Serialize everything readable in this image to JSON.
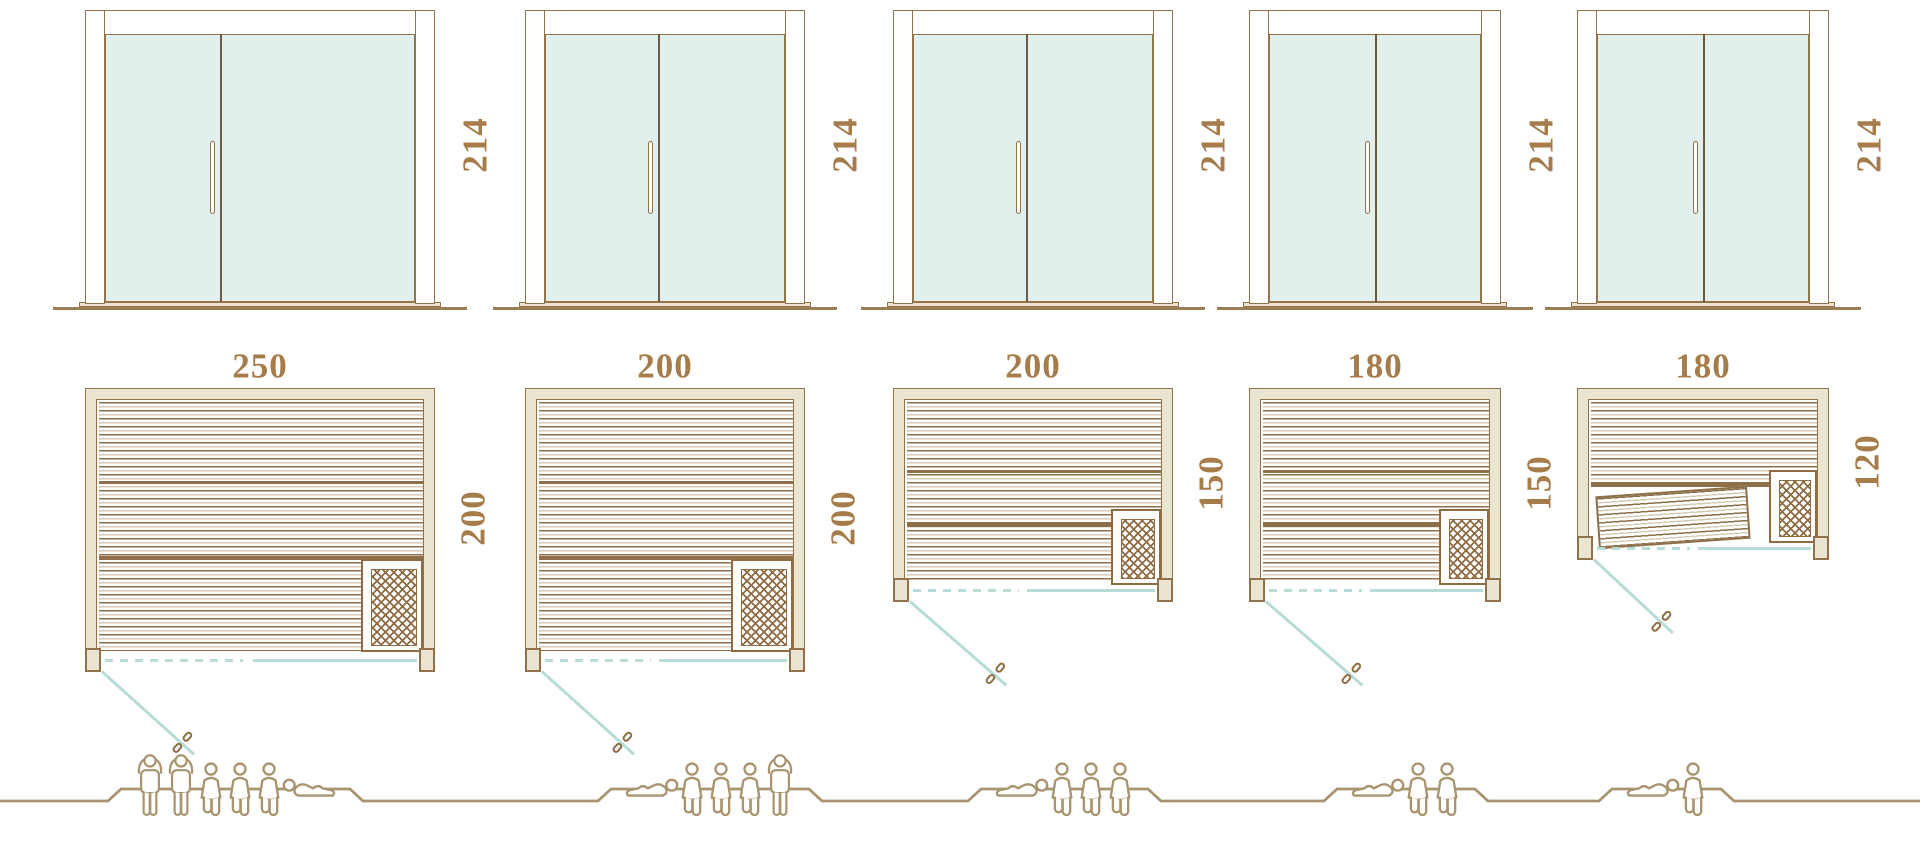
{
  "diagram_title": "sauna-cabin-size-comparison",
  "colors": {
    "outline_brown": "#93714a",
    "slat_brown": "#8d6f49",
    "slat_light": "#d8cbb3",
    "wall_fill": "#eae5d1",
    "glass_fill": "#e2f0ed",
    "glass_outline": "#97764c",
    "door_divider": "#6f5940",
    "teal_line": "#b7dbd7",
    "dimension_text": "#a57c4a",
    "people_outline": "#a8946e",
    "ground_line": "#9b7d55",
    "heater_coil": "#8f6b42",
    "white": "#ffffff"
  },
  "units": [
    {
      "id": "sauna-250x200",
      "door": {
        "height_label": "214",
        "height_cm": 214
      },
      "plan": {
        "width_label": "250",
        "width_cm": 250,
        "depth_label": "200",
        "depth_cm": 200,
        "heater": true,
        "tilted_bench": false
      },
      "people": {
        "capacity": 6,
        "figures": [
          "standing",
          "standing",
          "seated",
          "seated",
          "seated",
          "reclining"
        ]
      }
    },
    {
      "id": "sauna-200x200",
      "door": {
        "height_label": "214",
        "height_cm": 214
      },
      "plan": {
        "width_label": "200",
        "width_cm": 200,
        "depth_label": "200",
        "depth_cm": 200,
        "heater": true,
        "tilted_bench": false
      },
      "people": {
        "capacity": 5,
        "figures": [
          "reclining",
          "seated",
          "seated",
          "seated",
          "standing"
        ]
      }
    },
    {
      "id": "sauna-200x150",
      "door": {
        "height_label": "214",
        "height_cm": 214
      },
      "plan": {
        "width_label": "200",
        "width_cm": 200,
        "depth_label": "150",
        "depth_cm": 150,
        "heater": true,
        "tilted_bench": false
      },
      "people": {
        "capacity": 4,
        "figures": [
          "reclining",
          "seated",
          "seated",
          "seated"
        ]
      }
    },
    {
      "id": "sauna-180x150",
      "door": {
        "height_label": "214",
        "height_cm": 214
      },
      "plan": {
        "width_label": "180",
        "width_cm": 180,
        "depth_label": "150",
        "depth_cm": 150,
        "heater": true,
        "tilted_bench": false
      },
      "people": {
        "capacity": 3,
        "figures": [
          "reclining",
          "seated",
          "seated"
        ]
      }
    },
    {
      "id": "sauna-180x120",
      "door": {
        "height_label": "214",
        "height_cm": 214
      },
      "plan": {
        "width_label": "180",
        "width_cm": 180,
        "depth_label": "120",
        "depth_cm": 120,
        "heater": true,
        "tilted_bench": true
      },
      "people": {
        "capacity": 2,
        "figures": [
          "reclining",
          "seated"
        ]
      }
    }
  ]
}
